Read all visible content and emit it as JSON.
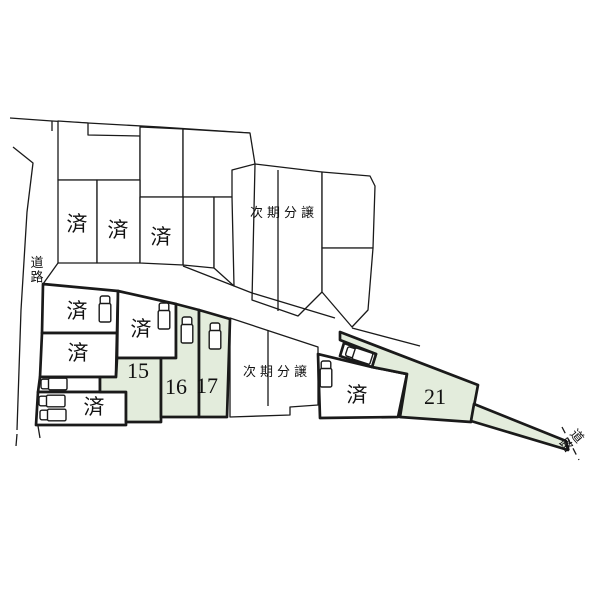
{
  "map": {
    "type": "real-estate-subdivision-lot-map",
    "colors": {
      "background": "#ffffff",
      "line": "#1a1a1a",
      "available_lot_fill": "#e3ecdc",
      "standard_lot_fill": "#ffffff"
    },
    "roads": {
      "left": {
        "label": "道路"
      },
      "right": {
        "label": "道路"
      }
    },
    "lots": {
      "back_row_sold": [
        {
          "label": "済"
        },
        {
          "label": "済"
        },
        {
          "label": "済"
        }
      ],
      "future_phase_top": {
        "label": "次期分譲"
      },
      "future_phase_bottom": {
        "label": "次期分譲"
      },
      "front_sold": [
        {
          "label": "済"
        },
        {
          "label": "済"
        },
        {
          "label": "済"
        },
        {
          "label": "済"
        },
        {
          "label": "済"
        }
      ],
      "available": [
        {
          "number": "15"
        },
        {
          "number": "16"
        },
        {
          "number": "17"
        },
        {
          "number": "21"
        }
      ],
      "car_icon_count": 9
    }
  }
}
